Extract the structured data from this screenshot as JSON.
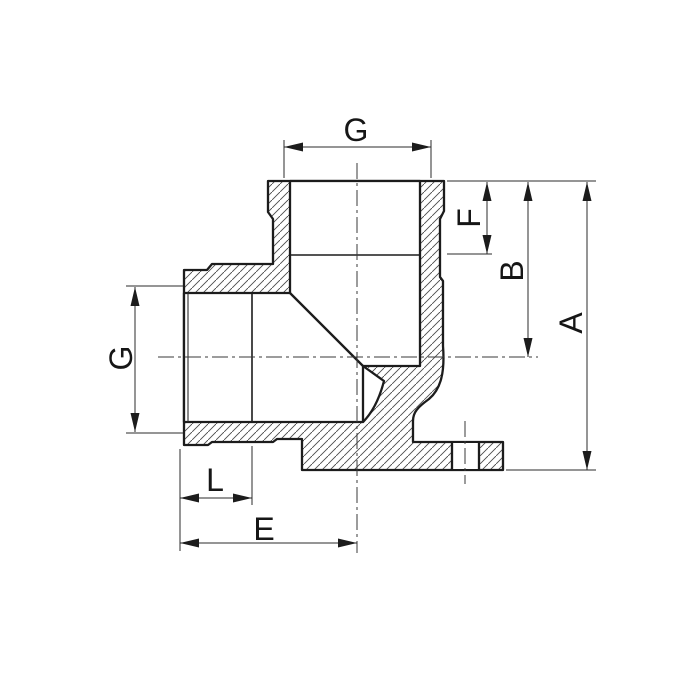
{
  "drawing": {
    "title": "Sectional technical drawing of a 90-degree female-threaded wall elbow fitting with mounting flange",
    "background_color": "#ffffff",
    "line_color": "#1c1c1c",
    "thin_line_color": "#2b2b2b",
    "centerline_color": "#3a3a3a",
    "hatch_color": "#4a4a4a",
    "dim_labels": {
      "g_top": "G",
      "f": "F",
      "b": "B",
      "a": "A",
      "g_side": "G",
      "l": "L",
      "e": "E"
    }
  }
}
